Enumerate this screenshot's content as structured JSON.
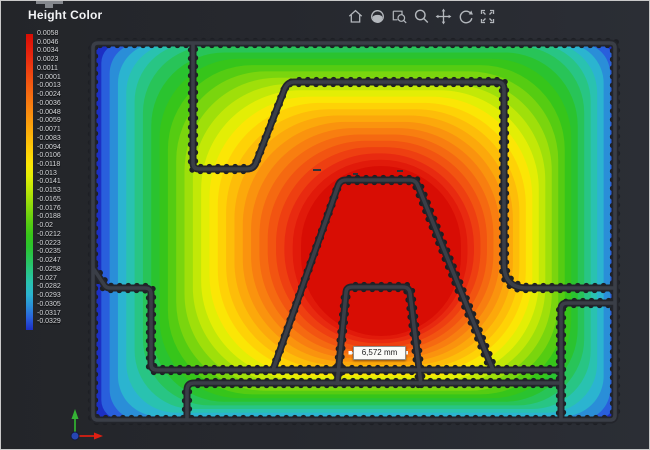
{
  "window": {
    "title": "Height Color"
  },
  "toolbar": {
    "icons": [
      "home-icon",
      "orbit-view-icon",
      "zoom-window-icon",
      "zoom-icon",
      "pan-icon",
      "rotate-icon",
      "fit-view-icon"
    ],
    "icon_color": "#b4b8bd"
  },
  "colorbar": {
    "labels": [
      "0.0058",
      "0.0046",
      "0.0034",
      "0.0023",
      "0.0011",
      "-0.0001",
      "-0.0013",
      "-0.0024",
      "-0.0036",
      "-0.0048",
      "-0.0059",
      "-0.0071",
      "-0.0083",
      "-0.0094",
      "-0.0106",
      "-0.0118",
      "-0.013",
      "-0.0141",
      "-0.0153",
      "-0.0165",
      "-0.0176",
      "-0.0188",
      "-0.02",
      "-0.0212",
      "-0.0223",
      "-0.0235",
      "-0.0247",
      "-0.0258",
      "-0.027",
      "-0.0282",
      "-0.0293",
      "-0.0305",
      "-0.0317",
      "-0.0329"
    ]
  },
  "heightmap": {
    "palette_center_to_edge": [
      "#d80d04",
      "#e11a0a",
      "#e82a10",
      "#ee3f11",
      "#f25411",
      "#f56911",
      "#f87e10",
      "#fa930e",
      "#fca80b",
      "#fdbd09",
      "#fed206",
      "#fbe605",
      "#e3ee05",
      "#c2e807",
      "#9fdf0a",
      "#7ad50e",
      "#55cc12",
      "#36c51a",
      "#2ac32f",
      "#28c458",
      "#28c584",
      "#29c2b0",
      "#2bb4d0",
      "#2a8ed8",
      "#295fdc",
      "#1c2fc4"
    ],
    "wall_color": "#3a3e47",
    "wall_outline_color": "#23252b",
    "dot_color": "#1d1f24",
    "scene_background": "#26282e"
  },
  "measurement": {
    "value": "6,572 mm"
  },
  "axis_triad": {
    "x_color": "#df1f12",
    "y_color": "#35b335",
    "z_color": "#2746b2"
  },
  "chart_data": {
    "type": "heatmap",
    "title": "Height Color",
    "legend_ticks": [
      0.0058,
      0.0046,
      0.0034,
      0.0023,
      0.0011,
      -0.0001,
      -0.0013,
      -0.0024,
      -0.0036,
      -0.0048,
      -0.0059,
      -0.0071,
      -0.0083,
      -0.0094,
      -0.0106,
      -0.0118,
      -0.013,
      -0.0141,
      -0.0153,
      -0.0165,
      -0.0176,
      -0.0188,
      -0.02,
      -0.0212,
      -0.0223,
      -0.0235,
      -0.0247,
      -0.0258,
      -0.027,
      -0.0282,
      -0.0293,
      -0.0305,
      -0.0317,
      -0.0329
    ],
    "value_range": [
      -0.0329,
      0.0058
    ],
    "legend_position": "left",
    "annotations": [
      {
        "label": "6,572 mm",
        "kind": "distance-dimension"
      }
    ],
    "description_visible": "Height deviation map: red high region at part center, blue low at part edges/corners"
  }
}
